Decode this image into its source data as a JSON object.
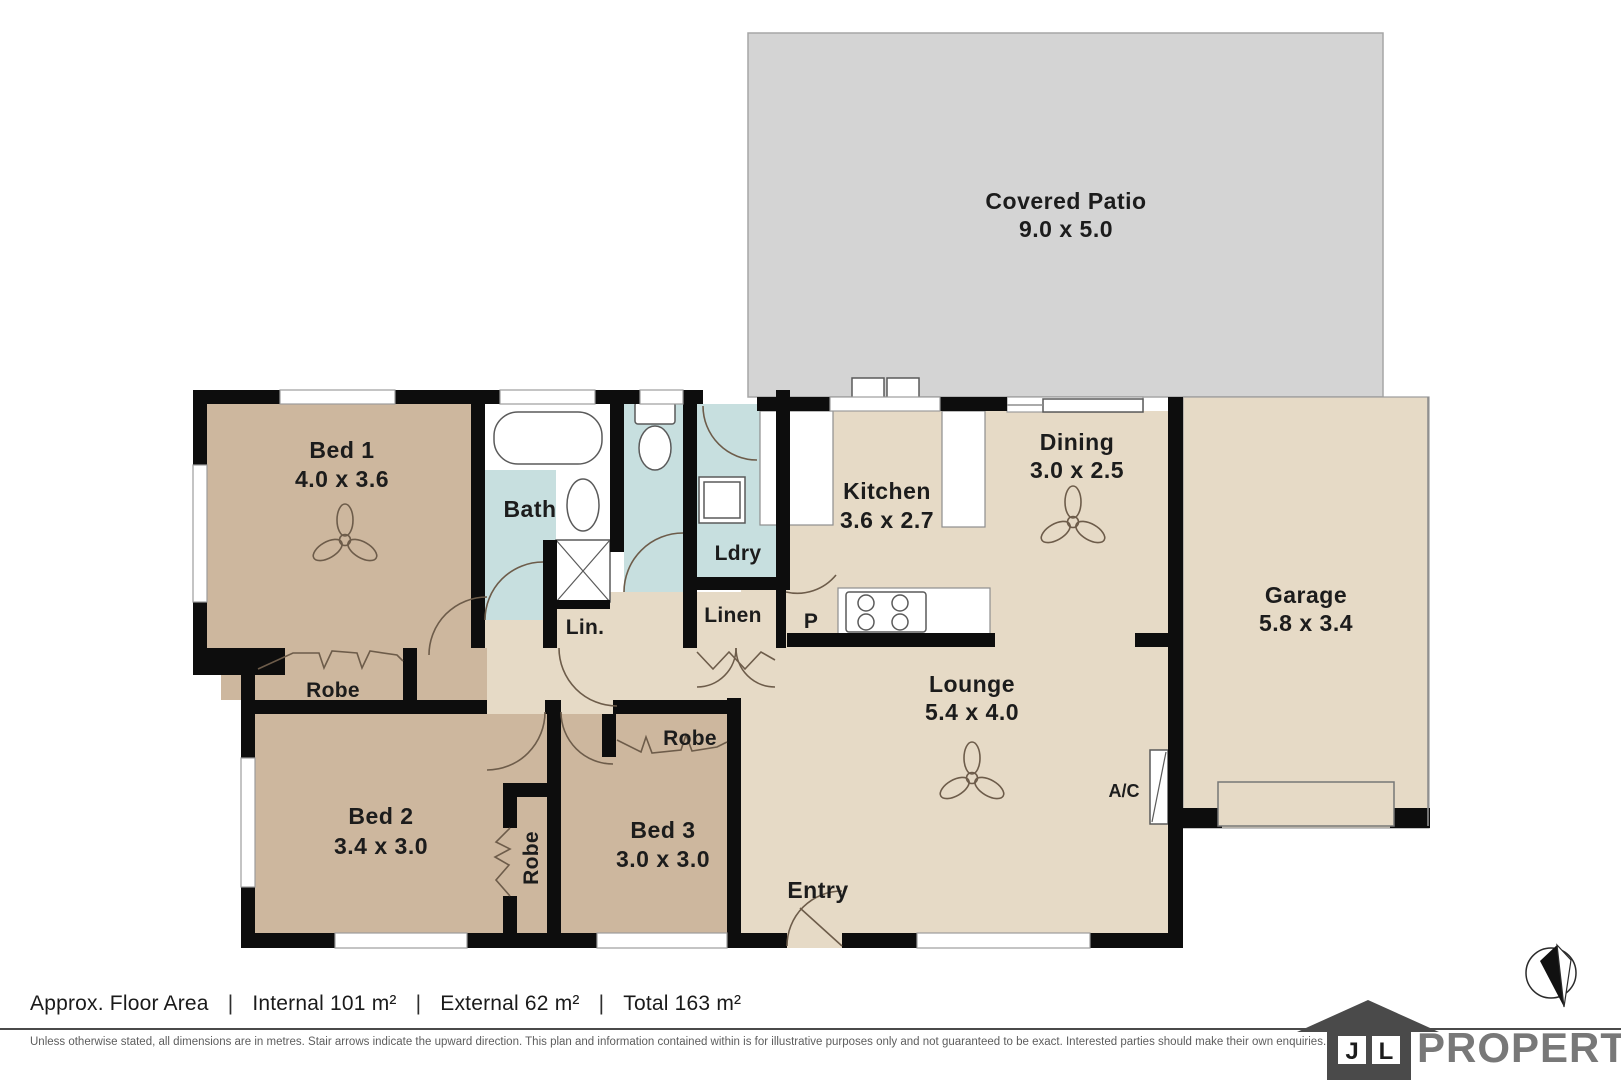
{
  "plan": {
    "patio": {
      "name": "Covered Patio",
      "dims": "9.0 x 5.0"
    },
    "bed1": {
      "name": "Bed 1",
      "dims": "4.0 x 3.6"
    },
    "bed2": {
      "name": "Bed 2",
      "dims": "3.4 x 3.0"
    },
    "bed3": {
      "name": "Bed 3",
      "dims": "3.0 x 3.0"
    },
    "kitchen": {
      "name": "Kitchen",
      "dims": "3.6 x 2.7"
    },
    "dining": {
      "name": "Dining",
      "dims": "3.0 x 2.5"
    },
    "lounge": {
      "name": "Lounge",
      "dims": "5.4 x 4.0"
    },
    "garage": {
      "name": "Garage",
      "dims": "5.8 x 3.4"
    },
    "bath": {
      "name": "Bath"
    },
    "laundry": {
      "name": "Ldry"
    },
    "linen_small": {
      "name": "Lin."
    },
    "linen": {
      "name": "Linen"
    },
    "pantry": {
      "name": "P"
    },
    "entry": {
      "name": "Entry"
    },
    "robe_bed1": {
      "name": "Robe"
    },
    "robe_bed2": {
      "name": "Robe"
    },
    "robe_bed3": {
      "name": "Robe"
    },
    "ac": {
      "name": "A/C"
    }
  },
  "footer": {
    "area_label": "Approx. Floor Area",
    "sep": "|",
    "internal": "Internal 101 m²",
    "external": "External 62 m²",
    "total": "Total 163 m²",
    "disclaimer": "Unless otherwise stated, all dimensions are in metres. Stair arrows indicate the upward direction. This plan and information contained within is for illustrative purposes only and not guaranteed to be exact. Interested parties should make their own enquiries."
  },
  "logo": {
    "initial_j": "J",
    "initial_l": "L",
    "brand": "PROPERTY"
  },
  "colors": {
    "wall": "#0d0d0d",
    "floor_living": "#e6dac6",
    "floor_bed": "#cdb79e",
    "floor_wet": "#c7dfdf",
    "floor_patio": "#d4d4d4",
    "line_brown": "#6d5c4a",
    "text_dark": "#1c1c1c"
  }
}
